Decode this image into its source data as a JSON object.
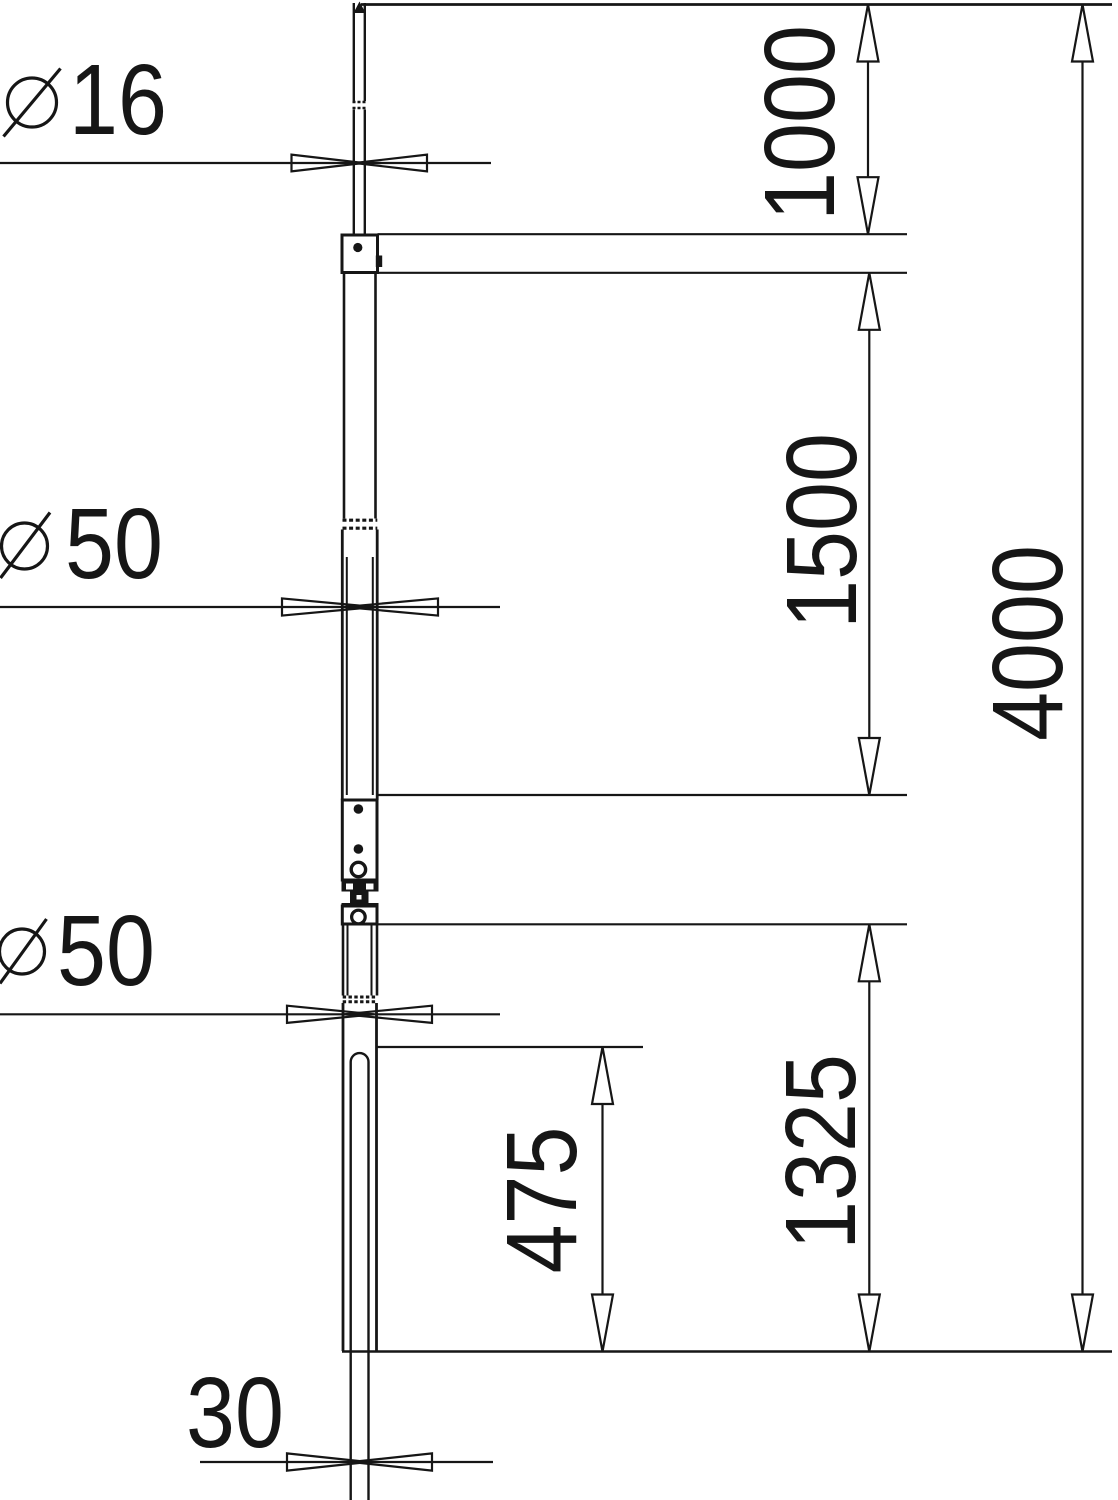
{
  "page": {
    "background": "#ffffff",
    "line_color": "#161616",
    "description_labels": {
      "tip_diameter": {
        "symbol": "⌀",
        "value": "16"
      },
      "upper_tube_diameter": {
        "symbol": "⌀",
        "value": "50"
      },
      "lower_tube_diameter": {
        "symbol": "⌀",
        "value": "50"
      },
      "earth_rod_width": {
        "value": "30"
      },
      "tip_section_length": {
        "value": "1000"
      },
      "middle_section_length": {
        "value": "1500"
      },
      "lower_section_length": {
        "value": "1325"
      },
      "insertion_length": {
        "value": "475"
      },
      "total_length": {
        "value": "4000"
      }
    }
  }
}
